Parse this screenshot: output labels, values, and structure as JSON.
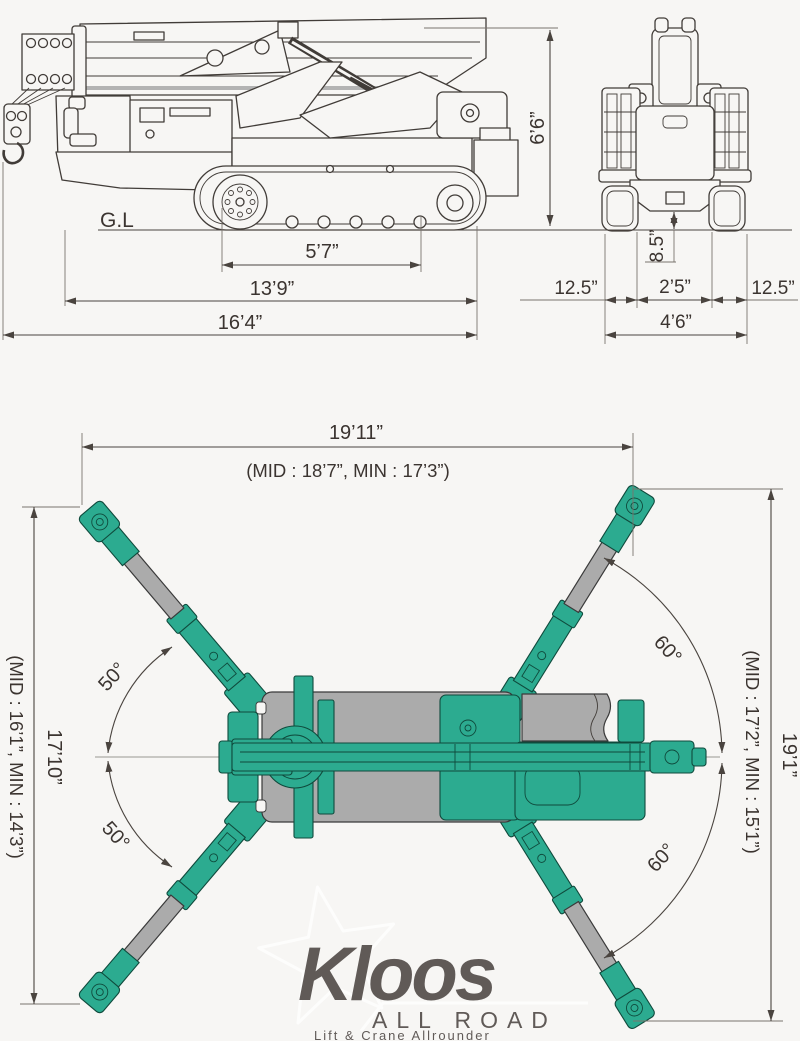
{
  "canvas": {
    "width": 800,
    "height": 1041,
    "background": "#f7f6f4"
  },
  "colors": {
    "crane_teal": "#2cab90",
    "crane_teal_outline": "#0f4a3c",
    "track_gray": "#ababab",
    "drawing_line": "#413c38",
    "dimension_line": "#4a443f",
    "dimension_text": "#3b3430",
    "watermark": "#ffffff"
  },
  "side_view": {
    "ground_label": "G.L",
    "dim_height": "6’6”",
    "dim_track_length": "5’7”",
    "dim_frame_length": "13’9”",
    "dim_overall_length": "16’4”"
  },
  "front_view": {
    "dim_ground_clearance": "8.5”",
    "dim_left_track_width": "12.5”",
    "dim_track_gap": "2’5”",
    "dim_right_track_width": "12.5”",
    "dim_overall_width": "4’6”"
  },
  "plan_view": {
    "dim_outrigger_span_top": "19’11”",
    "dim_outrigger_span_top_sub": "(MID : 18’7”, MIN : 17’3”)",
    "dim_outrigger_span_left": "17’10”",
    "dim_outrigger_span_left_sub": "(MID : 16’1”, MIN : 14’3”)",
    "dim_outrigger_span_right": "19’1”",
    "dim_outrigger_span_right_sub": "(MID : 17’2”, MIN : 15’1”)",
    "angle_front_outriggers": "50°",
    "angle_rear_outriggers": "60°"
  },
  "watermark": {
    "brand": "Kloos",
    "subtitle": "ALL ROAD",
    "tagline": "Lift & Crane Allrounder"
  }
}
